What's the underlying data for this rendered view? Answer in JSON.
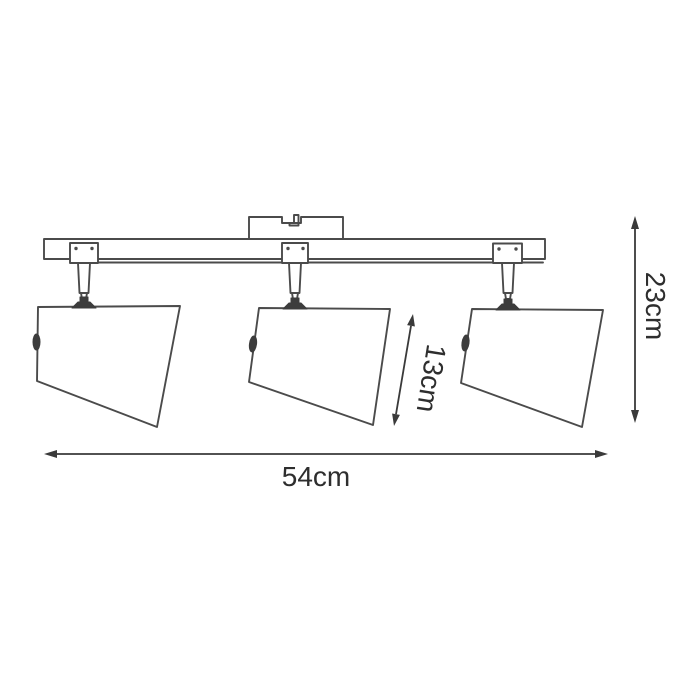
{
  "diagram": {
    "labels": {
      "width": "54cm",
      "height": "23cm",
      "shade": "13cm"
    },
    "colors": {
      "line": "#4b4b4b",
      "dark_part": "#3c3c3c",
      "dimension": "#3a3a3a",
      "text": "#2e2e2e",
      "background": "#ffffff"
    }
  }
}
